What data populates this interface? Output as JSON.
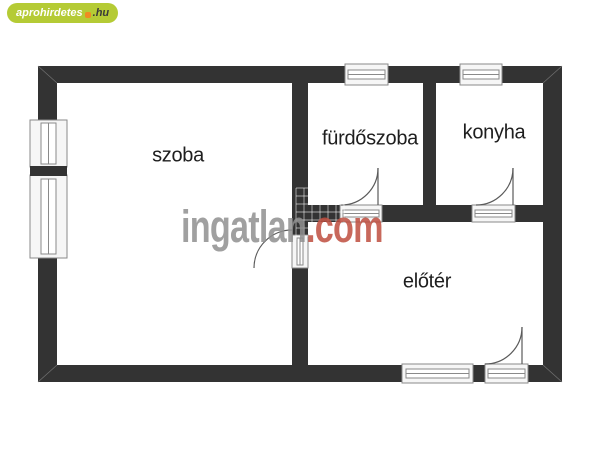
{
  "logo": {
    "site_name": "aprohirdetes",
    "tld": ".hu"
  },
  "watermark": {
    "name": "ingatlan",
    "tld": ".com"
  },
  "rooms": [
    {
      "id": "szoba",
      "label": "szoba"
    },
    {
      "id": "furdoszoba",
      "label": "fürdőszoba"
    },
    {
      "id": "konyha",
      "label": "konyha"
    },
    {
      "id": "eloter",
      "label": "előtér"
    }
  ],
  "colors": {
    "wall": "#333333",
    "window_border": "#8a8a8a",
    "door_arc": "#5a5a5a",
    "logo_green": "#b5cb35",
    "logo_dot_orange": "#ef8b22",
    "logo_tld": "#3a3a3a",
    "watermark_gray": "#909090",
    "watermark_red": "#bf4e3f",
    "label": "#1e1e1e"
  }
}
